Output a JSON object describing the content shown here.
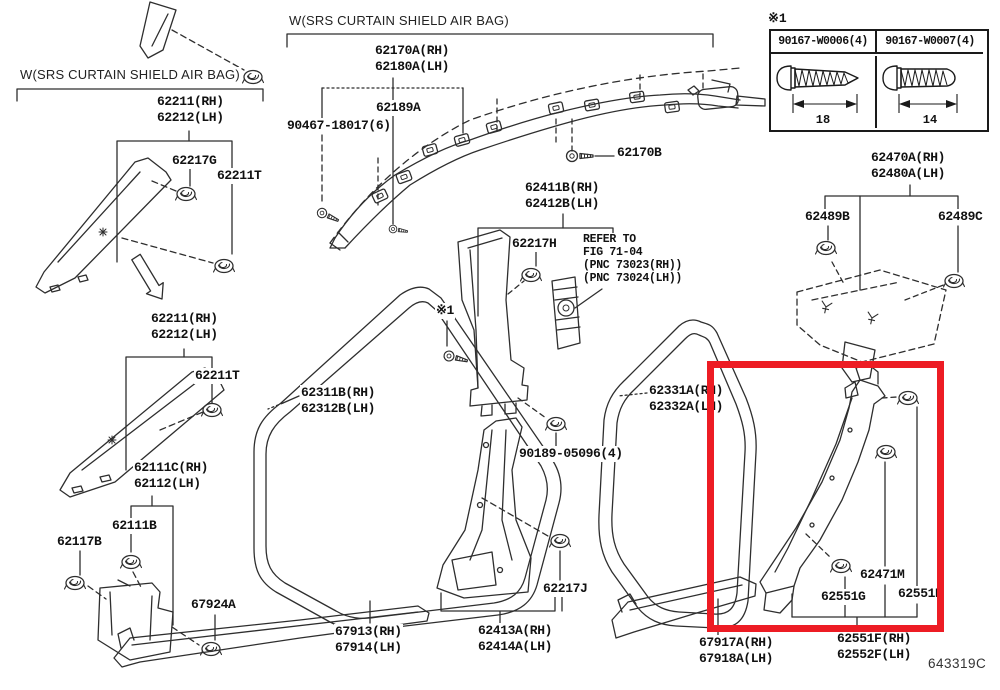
{
  "diagram": {
    "drawing_code": "643319C",
    "highlight_color": "#ed1c24",
    "headers": {
      "left": "W(SRS CURTAIN SHIELD AIR BAG)",
      "center": "W(SRS CURTAIN SHIELD AIR BAG)"
    },
    "fastener_table": {
      "marker": "※1",
      "columns": [
        {
          "part_number": "90167-W0006(4)",
          "length": "18"
        },
        {
          "part_number": "90167-W0007(4)",
          "length": "14"
        }
      ]
    },
    "refer_note": {
      "line1": "REFER TO",
      "line2": "FIG 71-04",
      "line3": "(PNC 73023(RH))",
      "line4": "(PNC 73024(LH))"
    },
    "labels": {
      "l62211_upper": {
        "line1": "62211(RH)",
        "line2": "62212(LH)"
      },
      "l62217G": {
        "line1": "62217G"
      },
      "l62211T_upper": {
        "line1": "62211T"
      },
      "l62211_lower": {
        "line1": "62211(RH)",
        "line2": "62212(LH)"
      },
      "l62211T_lower": {
        "line1": "62211T"
      },
      "l62111C": {
        "line1": "62111C(RH)",
        "line2": "62112(LH)"
      },
      "l62111B": {
        "line1": "62111B"
      },
      "l62117B": {
        "line1": "62117B"
      },
      "l67924A": {
        "line1": "67924A"
      },
      "l62170A": {
        "line1": "62170A(RH)",
        "line2": "62180A(LH)"
      },
      "l62189A": {
        "line1": "62189A"
      },
      "l90467": {
        "line1": "90467-18017(6)"
      },
      "l62170B": {
        "line1": "62170B"
      },
      "l62411B": {
        "line1": "62411B(RH)",
        "line2": "62412B(LH)"
      },
      "l62217H": {
        "line1": "62217H"
      },
      "lstar1": {
        "line1": "※1"
      },
      "l90189": {
        "line1": "90189-05096(4)"
      },
      "l62311B": {
        "line1": "62311B(RH)",
        "line2": "62312B(LH)"
      },
      "l67913": {
        "line1": "67913(RH)",
        "line2": "67914(LH)"
      },
      "l62413A": {
        "line1": "62413A(RH)",
        "line2": "62414A(LH)"
      },
      "l62217J": {
        "line1": "62217J"
      },
      "l62331A": {
        "line1": "62331A(RH)",
        "line2": "62332A(LH)"
      },
      "l62470A": {
        "line1": "62470A(RH)",
        "line2": "62480A(LH)"
      },
      "l62489B": {
        "line1": "62489B"
      },
      "l62489C": {
        "line1": "62489C"
      },
      "l62471M": {
        "line1": "62471M"
      },
      "l62551G": {
        "line1": "62551G"
      },
      "l62551H": {
        "line1": "62551H"
      },
      "l67917A": {
        "line1": "67917A(RH)",
        "line2": "67918A(LH)"
      },
      "l62551F": {
        "line1": "62551F(RH)",
        "line2": "62552F(LH)"
      }
    }
  }
}
